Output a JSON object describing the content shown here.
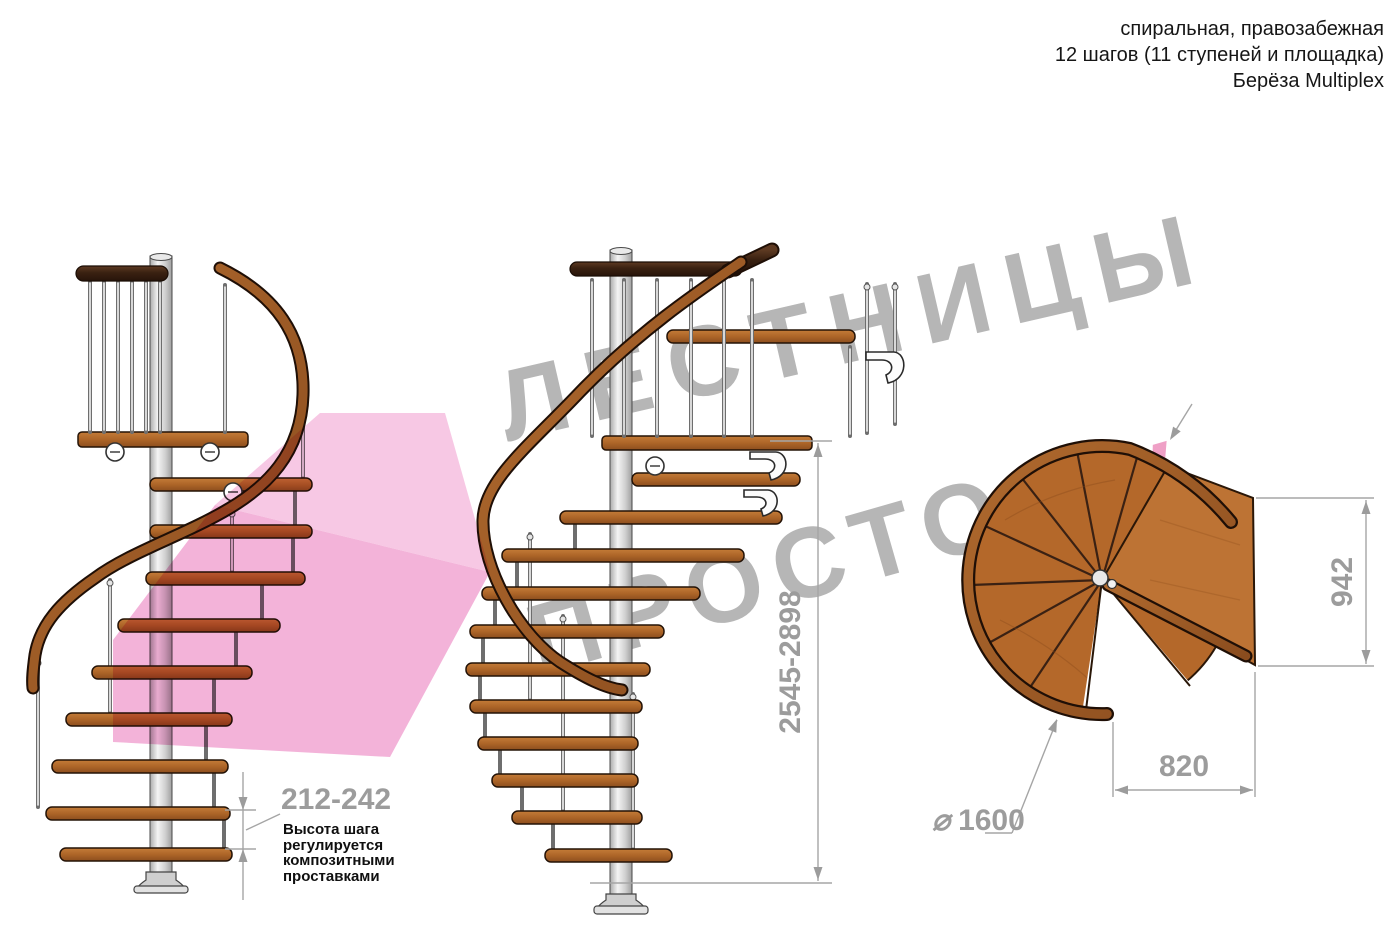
{
  "header": {
    "line1": "спиральная, правозабежная",
    "line2": "12 шагов (11 ступеней и площадка)",
    "line3": "Берёза Multiplex"
  },
  "watermark": {
    "line1": "ЛЕСТНИЦЫ",
    "line2": "ПРОСТО",
    "dot": ".",
    "suffix": "ру"
  },
  "dimensions": {
    "step_height": {
      "value": "212-242",
      "note": [
        "Высота шага",
        "регулируется",
        "композитными",
        "проставками"
      ]
    },
    "total_height": {
      "value": "2545-2898"
    },
    "landing_depth": {
      "value": "942"
    },
    "landing_width": {
      "value": "820"
    },
    "diameter": {
      "symbol": "⌀",
      "value": "1600"
    }
  },
  "colors": {
    "wood": "#b0662c",
    "wood_dark": "#7c451c",
    "rail_dark": "#41261563",
    "handrail": "#9c5a26",
    "metal": "#d9d9d9",
    "dim_gray": "#9c9c9c",
    "watermark_gray": "#b6b6b6",
    "watermark_pink": "#efa0c6",
    "watermark_dot": "#d0487a",
    "arrow_pink": "#f1a6d2",
    "text": "#161616"
  }
}
